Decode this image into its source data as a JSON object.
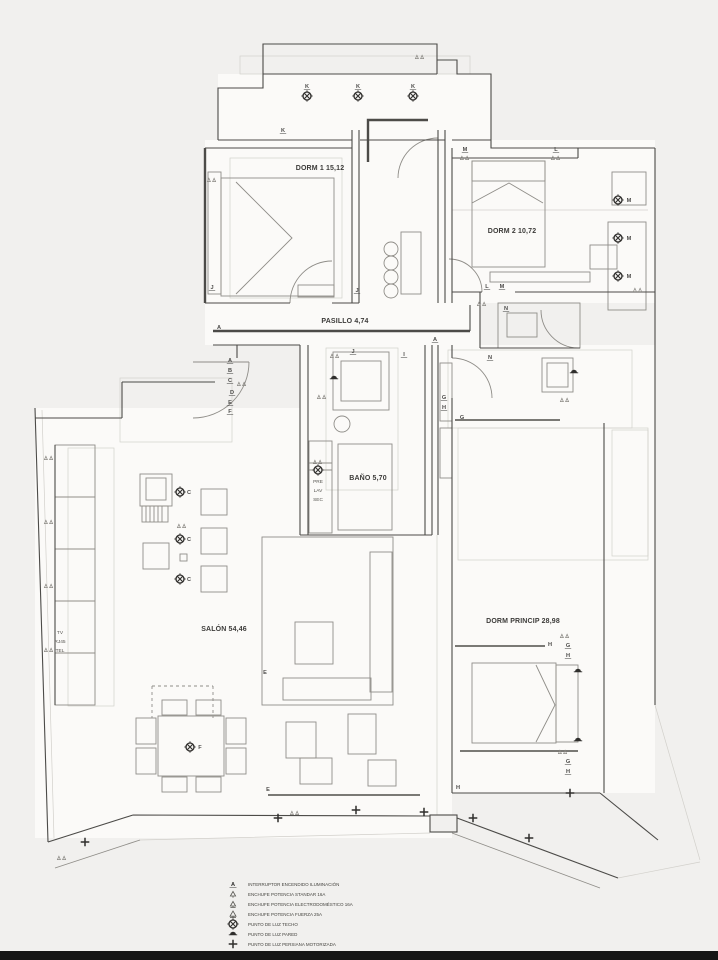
{
  "page": {
    "background": "#f1f0ee",
    "bottom_bar_color": "#161616"
  },
  "plan": {
    "rooms": [
      {
        "label": "DORM 1 15,12"
      },
      {
        "label": "DORM 2 10,72"
      },
      {
        "label": "PASILLO 4,74"
      },
      {
        "label": "BAÑO 5,70"
      },
      {
        "label": "SALÓN 54,46"
      },
      {
        "label": "DORM PRINCIP 28,98"
      }
    ],
    "small_labels": [
      {
        "text": "PRE"
      },
      {
        "text": "LAV"
      },
      {
        "text": "SEC"
      },
      {
        "text": "TV"
      },
      {
        "text": "RJ45"
      },
      {
        "text": "TEL"
      }
    ],
    "switch_letters": [
      {
        "t": "K",
        "x": 283,
        "y": 132,
        "u": 1
      },
      {
        "t": "K",
        "x": 307,
        "y": 88,
        "u": 1
      },
      {
        "t": "K",
        "x": 358,
        "y": 88,
        "u": 1
      },
      {
        "t": "K",
        "x": 413,
        "y": 88,
        "u": 1
      },
      {
        "t": "M",
        "x": 465,
        "y": 151,
        "u": 1
      },
      {
        "t": "L",
        "x": 556,
        "y": 151,
        "u": 1
      },
      {
        "t": "J",
        "x": 212,
        "y": 289,
        "u": 1
      },
      {
        "t": "J",
        "x": 357,
        "y": 292,
        "u": 1
      },
      {
        "t": "L",
        "x": 487,
        "y": 288,
        "u": 1
      },
      {
        "t": "M",
        "x": 502,
        "y": 288,
        "u": 1
      },
      {
        "t": "A",
        "x": 219,
        "y": 329,
        "u": 1
      },
      {
        "t": "A",
        "x": 230,
        "y": 362,
        "u": 1
      },
      {
        "t": "B",
        "x": 230,
        "y": 372,
        "u": 1
      },
      {
        "t": "C",
        "x": 230,
        "y": 382,
        "u": 1
      },
      {
        "t": "D",
        "x": 232,
        "y": 394,
        "u": 1
      },
      {
        "t": "E",
        "x": 230,
        "y": 404,
        "u": 1
      },
      {
        "t": "F",
        "x": 230,
        "y": 413,
        "u": 1
      },
      {
        "t": "J",
        "x": 353,
        "y": 353,
        "u": 1
      },
      {
        "t": "I",
        "x": 404,
        "y": 356,
        "u": 1
      },
      {
        "t": "N",
        "x": 506,
        "y": 310,
        "u": 1
      },
      {
        "t": "N",
        "x": 490,
        "y": 359,
        "u": 1
      },
      {
        "t": "A",
        "x": 435,
        "y": 341,
        "u": 1
      },
      {
        "t": "G",
        "x": 444,
        "y": 399,
        "u": 1
      },
      {
        "t": "H",
        "x": 444,
        "y": 409,
        "u": 1
      },
      {
        "t": "G",
        "x": 568,
        "y": 647,
        "u": 1
      },
      {
        "t": "H",
        "x": 568,
        "y": 657,
        "u": 1
      },
      {
        "t": "G",
        "x": 568,
        "y": 763,
        "u": 1
      },
      {
        "t": "H",
        "x": 568,
        "y": 773,
        "u": 1
      },
      {
        "t": "M",
        "x": 629,
        "y": 202,
        "u": 0
      },
      {
        "t": "M",
        "x": 629,
        "y": 240,
        "u": 0
      },
      {
        "t": "M",
        "x": 629,
        "y": 278,
        "u": 0
      },
      {
        "t": "C",
        "x": 189,
        "y": 494,
        "u": 0
      },
      {
        "t": "C",
        "x": 189,
        "y": 541,
        "u": 0
      },
      {
        "t": "C",
        "x": 189,
        "y": 581,
        "u": 0
      },
      {
        "t": "F",
        "x": 200,
        "y": 749,
        "u": 0
      },
      {
        "t": "E",
        "x": 265,
        "y": 674,
        "u": 0
      },
      {
        "t": "E",
        "x": 268,
        "y": 791,
        "u": 0
      },
      {
        "t": "H",
        "x": 550,
        "y": 646,
        "u": 0
      },
      {
        "t": "H",
        "x": 458,
        "y": 789,
        "u": 0
      },
      {
        "t": "G",
        "x": 462,
        "y": 419,
        "u": 0
      }
    ],
    "ceiling_lights": [
      [
        307,
        96
      ],
      [
        358,
        96
      ],
      [
        413,
        96
      ],
      [
        618,
        200
      ],
      [
        618,
        238
      ],
      [
        618,
        276
      ],
      [
        180,
        492
      ],
      [
        180,
        539
      ],
      [
        180,
        579
      ],
      [
        190,
        747
      ],
      [
        318,
        470
      ]
    ],
    "wall_lights": [
      [
        334,
        378
      ],
      [
        574,
        372
      ],
      [
        578,
        671
      ],
      [
        578,
        740
      ]
    ],
    "blind_points": [
      [
        85,
        842
      ],
      [
        278,
        818
      ],
      [
        356,
        810
      ],
      [
        424,
        812
      ],
      [
        473,
        818
      ],
      [
        529,
        838
      ],
      [
        570,
        793
      ]
    ],
    "sockets": [
      [
        420,
        57
      ],
      [
        465,
        158
      ],
      [
        556,
        158
      ],
      [
        212,
        180
      ],
      [
        638,
        290
      ],
      [
        482,
        304
      ],
      [
        242,
        384
      ],
      [
        565,
        400
      ],
      [
        318,
        462
      ],
      [
        565,
        636
      ],
      [
        563,
        752
      ],
      [
        62,
        858
      ],
      [
        295,
        813
      ],
      [
        49,
        458
      ],
      [
        49,
        522
      ],
      [
        49,
        586
      ],
      [
        49,
        650
      ],
      [
        182,
        526
      ],
      [
        335,
        356
      ],
      [
        322,
        397
      ]
    ]
  },
  "legend": {
    "items": [
      {
        "icon": "switch-icon",
        "glyph": "A",
        "label": "INTERRUPTOR ENCENDIDO ILUMINACIÓN"
      },
      {
        "icon": "socket-standard-icon",
        "label": "ENCHUFE POTENCIA STANDAR 16A"
      },
      {
        "icon": "socket-appliance-icon",
        "label": "ENCHUFE POTENCIA ELECTRODOMÉSTICO 16A"
      },
      {
        "icon": "socket-power-icon",
        "label": "ENCHUFE POTENCIA FUERZA 25A"
      },
      {
        "icon": "ceiling-light-icon",
        "label": "PUNTO DE LUZ TECHO"
      },
      {
        "icon": "wall-light-icon",
        "label": "PUNTO DE LUZ PARED"
      },
      {
        "icon": "motorized-blind-icon",
        "label": "PUNTO DE LUZ PERSIANA MOTORIZADA"
      }
    ]
  }
}
